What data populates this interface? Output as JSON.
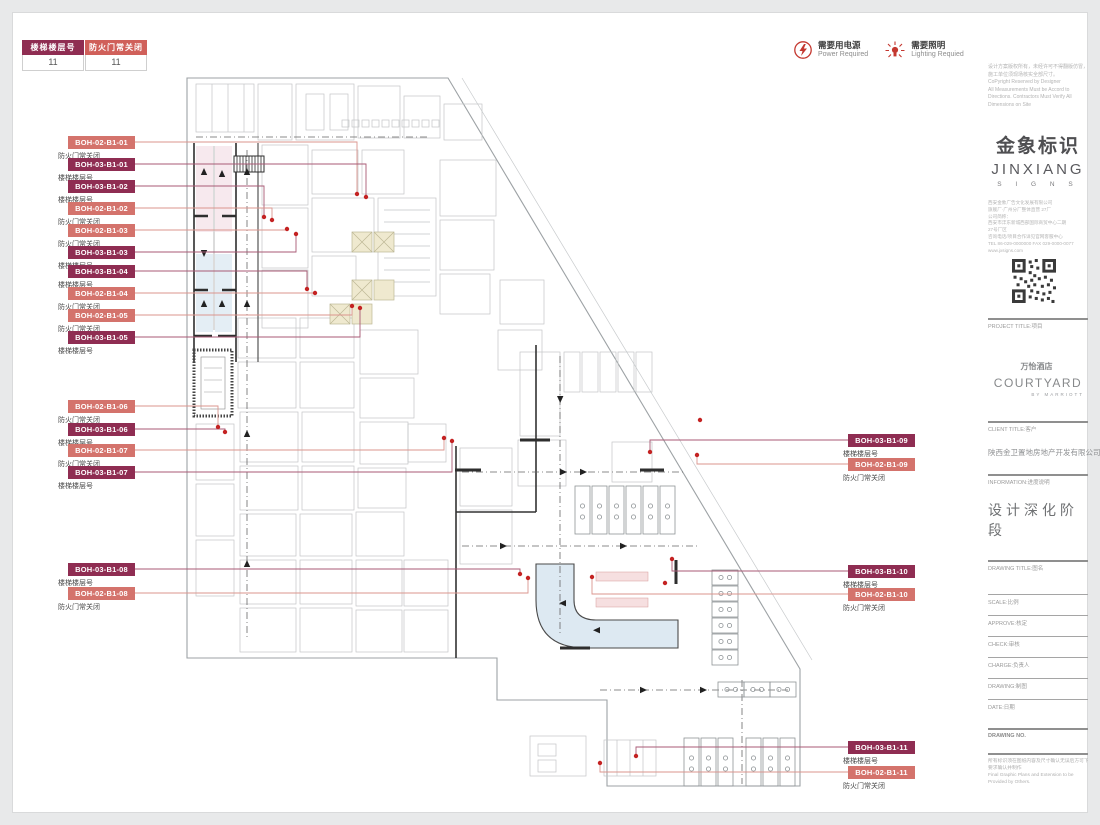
{
  "legend_table": {
    "columns": [
      {
        "header": "楼梯楼层号",
        "value": "11",
        "color": "#8f2d52"
      },
      {
        "header": "防火门常关闭",
        "value": "11",
        "color": "#d0605a"
      }
    ]
  },
  "legend_icons": {
    "power": {
      "zh": "需要用电源",
      "en": "Power Required"
    },
    "lighting": {
      "zh": "需要照明",
      "en": "Lighting Requied"
    }
  },
  "colors": {
    "stair": "#8f2d52",
    "door": "#d4736c",
    "line_stair": "#a85a75",
    "line_door": "#db958e",
    "dot": "#c42222"
  },
  "labels_left": [
    {
      "code": "BOH-02-B1-01",
      "caption": "防火门常关闭",
      "kind": "door",
      "top": 136
    },
    {
      "code": "BOH-03-B1-01",
      "caption": "楼梯楼层号",
      "kind": "stair",
      "top": 158
    },
    {
      "code": "BOH-03-B1-02",
      "caption": "楼梯楼层号",
      "kind": "stair",
      "top": 180
    },
    {
      "code": "BOH-02-B1-02",
      "caption": "防火门常关闭",
      "kind": "door",
      "top": 202
    },
    {
      "code": "BOH-02-B1-03",
      "caption": "防火门常关闭",
      "kind": "door",
      "top": 224
    },
    {
      "code": "BOH-03-B1-03",
      "caption": "楼梯楼层号",
      "kind": "stair",
      "top": 246
    },
    {
      "code": "BOH-03-B1-04",
      "caption": "楼梯楼层号",
      "kind": "stair",
      "top": 265
    },
    {
      "code": "BOH-02-B1-04",
      "caption": "防火门常关闭",
      "kind": "door",
      "top": 287
    },
    {
      "code": "BOH-02-B1-05",
      "caption": "防火门常关闭",
      "kind": "door",
      "top": 309
    },
    {
      "code": "BOH-03-B1-05",
      "caption": "楼梯楼层号",
      "kind": "stair",
      "top": 331
    },
    {
      "code": "BOH-02-B1-06",
      "caption": "防火门常关闭",
      "kind": "door",
      "top": 400
    },
    {
      "code": "BOH-03-B1-06",
      "caption": "楼梯楼层号",
      "kind": "stair",
      "top": 423
    },
    {
      "code": "BOH-02-B1-07",
      "caption": "防火门常关闭",
      "kind": "door",
      "top": 444
    },
    {
      "code": "BOH-03-B1-07",
      "caption": "楼梯楼层号",
      "kind": "stair",
      "top": 466
    },
    {
      "code": "BOH-03-B1-08",
      "caption": "楼梯楼层号",
      "kind": "stair",
      "top": 563
    },
    {
      "code": "BOH-02-B1-08",
      "caption": "防火门常关闭",
      "kind": "door",
      "top": 587
    }
  ],
  "labels_right": [
    {
      "code": "BOH-03-B1-09",
      "caption": "楼梯楼层号",
      "kind": "stair",
      "top": 434
    },
    {
      "code": "BOH-02-B1-09",
      "caption": "防火门常关闭",
      "kind": "door",
      "top": 458
    },
    {
      "code": "BOH-03-B1-10",
      "caption": "楼梯楼层号",
      "kind": "stair",
      "top": 565
    },
    {
      "code": "BOH-02-B1-10",
      "caption": "防火门常关闭",
      "kind": "door",
      "top": 588
    },
    {
      "code": "BOH-03-B1-11",
      "caption": "楼梯楼层号",
      "kind": "stair",
      "top": 741
    },
    {
      "code": "BOH-02-B1-11",
      "caption": "防火门常关闭",
      "kind": "door",
      "top": 766
    }
  ],
  "titleblock": {
    "copyright_lines": [
      "设计方案版权所有，未经许可不得翻版仿冒，",
      "施工单位须现场核实全部尺寸。",
      "CoPyright Reserved by Designer",
      "All Measurements Must be Accord to",
      "Directions. Contractors Must Verify All",
      "Dimensions on Site"
    ],
    "logo": {
      "zh": "金象标识",
      "en": "JINXIANG",
      "sub": "S I G N S"
    },
    "company_lines": [
      "西安金象广告文化发展有限公司",
      "旗舰厂·广州分厂整体直营 27厂",
      "公司简称：",
      "西安市沣东新城西部国际商贸中心二期",
      "27号厂区",
      "咨询电话/项目合作详见官网客服中心",
      "TEL 86-029-0000000 FAX 029-0000-0077",
      "www.jxsigns.com"
    ],
    "project_label": "PROJECT TITLE:项目",
    "project_logo": {
      "zh": "万怡酒店",
      "en": "COURTYARD",
      "sub": "BY MARRIOTT"
    },
    "client_label": "CLIENT TITLE:客户",
    "client_name": "陕西金卫置地房地产开发有限公司",
    "info_label": "INFORMATION:进度说明",
    "stage": "设计深化阶段",
    "drawing_title_label": "DRAWING TITLE:图名",
    "fields": [
      "SCALE:比例",
      "APPROVE:核定",
      "CHECK:审核",
      "CHARGE:负责人",
      "DRAWING:制图",
      "DATE:日期"
    ],
    "drawing_no_label": "DRAWING NO.",
    "note_lines": [
      "所有标识须在图纸内容及尺寸确认无误后方可下单",
      "要求确认并制作",
      "Final Graphic Plans and Extension to be",
      "Provided by Others."
    ]
  }
}
